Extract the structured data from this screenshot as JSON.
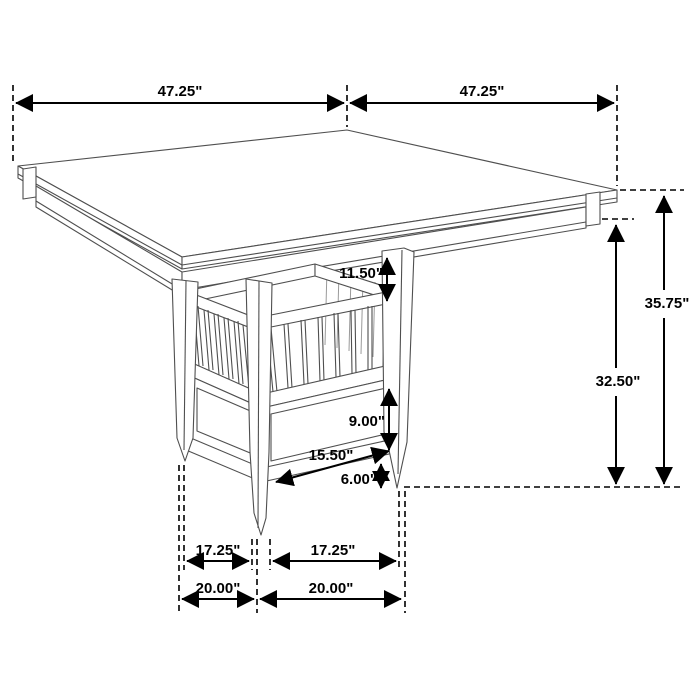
{
  "diagram": {
    "background": "#ffffff",
    "dimension_color": "#000000",
    "furniture_line_color": "#4f4f4f",
    "dims": {
      "top_left": "47.25\"",
      "top_right": "47.25\"",
      "overall_height": "35.75\"",
      "underside_height": "32.50\"",
      "shelf_opening": "11.50\"",
      "cabinet_height": "9.00\"",
      "base_length": "15.50\"",
      "foot_height": "6.00\"",
      "inner_left": "17.25\"",
      "inner_right": "17.25\"",
      "outer_left": "20.00\"",
      "outer_right": "20.00\""
    }
  }
}
